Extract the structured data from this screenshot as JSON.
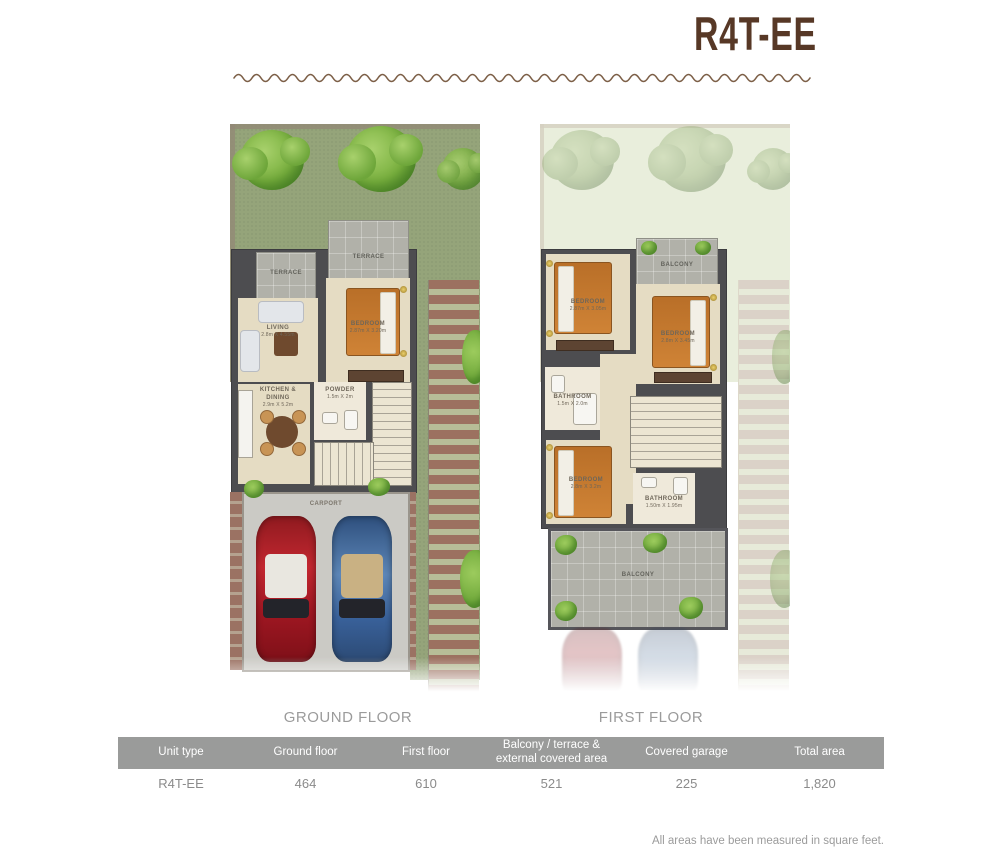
{
  "title": "R4T-EE",
  "ground_floor": {
    "caption": "GROUND FLOOR",
    "rooms": {
      "terrace_left": {
        "label": "TERRACE"
      },
      "terrace_main": {
        "label": "TERRACE"
      },
      "living": {
        "label": "LIVING",
        "dims": "2.8m X 4.55m"
      },
      "bedroom": {
        "label": "BEDROOM",
        "dims": "2.87m X 3.20m"
      },
      "kitchen": {
        "label": "KITCHEN & DINING",
        "dims": "2.9m X 5.2m"
      },
      "powder": {
        "label": "POWDER",
        "dims": "1.5m X 2m"
      },
      "carport": {
        "label": "CARPORT"
      }
    }
  },
  "first_floor": {
    "caption": "FIRST FLOOR",
    "rooms": {
      "balcony_top": {
        "label": "BALCONY"
      },
      "bedroom_1": {
        "label": "BEDROOM",
        "dims": "2.87m X 3.05m"
      },
      "bedroom_2": {
        "label": "BEDROOM",
        "dims": "2.8m X 3.45m"
      },
      "bathroom_1": {
        "label": "BATHROOM",
        "dims": "1.5m X 2.0m"
      },
      "bedroom_3": {
        "label": "BEDROOM",
        "dims": "2.8m X 3.2m"
      },
      "bathroom_2": {
        "label": "BATHROOM",
        "dims": "1.50m X 1.95m"
      },
      "balcony_bottom": {
        "label": "BALCONY"
      }
    }
  },
  "table": {
    "headers": [
      "Unit type",
      "Ground floor",
      "First floor",
      "Balcony / terrace & external covered area",
      "Covered garage",
      "Total area"
    ],
    "row": [
      "R4T-EE",
      "464",
      "610",
      "521",
      "225",
      "1,820"
    ]
  },
  "footer_note": "All areas have been measured in square feet.",
  "colors": {
    "accent_brown": "#573826",
    "wave_brown": "#7d6048",
    "table_header_bg": "#9a9b9a",
    "caption_gray": "#9b9b9b",
    "lawn_green": "#95a47a",
    "bed_orange": "#c9792e",
    "car_red": "#b02028",
    "car_blue": "#40679c"
  }
}
